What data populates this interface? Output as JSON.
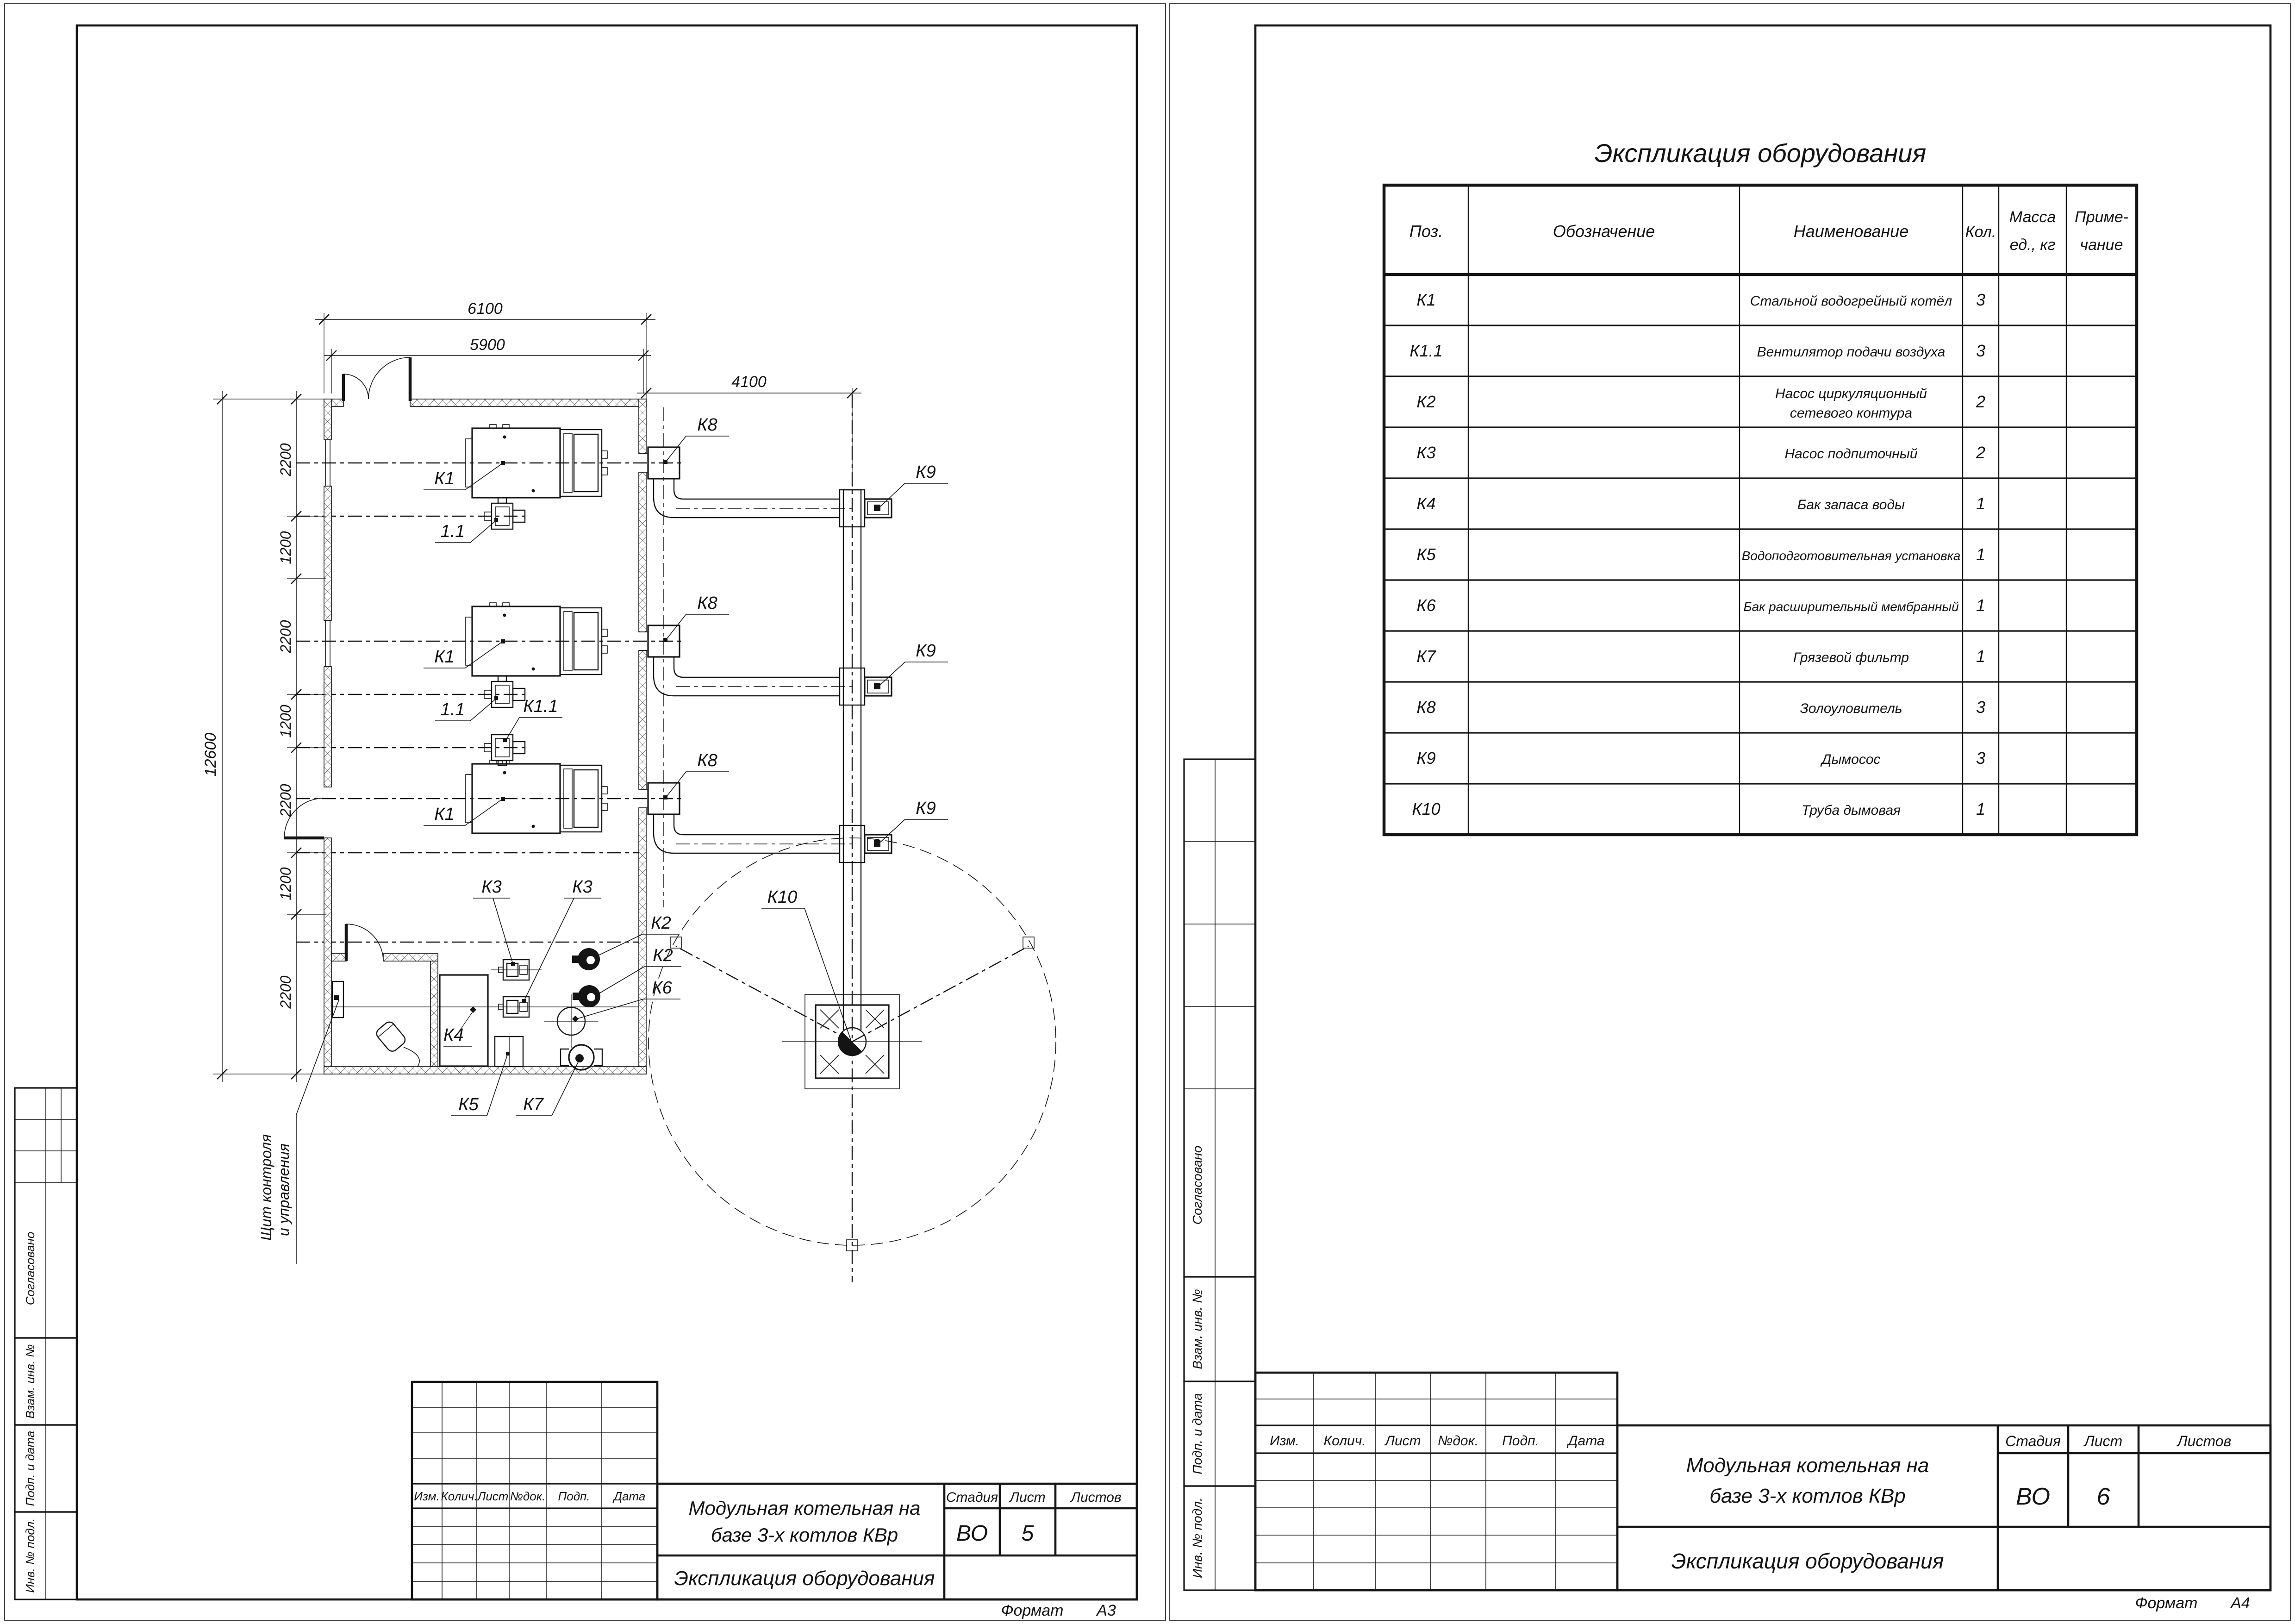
{
  "drawing": {
    "plan_labels": {
      "k1": "К1",
      "fan": "1.1",
      "k1_1": "К1.1",
      "k2": "К2",
      "k3": "К3",
      "k4": "К4",
      "k5": "К5",
      "k6": "К6",
      "k7": "К7",
      "k8": "К8",
      "k9": "К9",
      "k10": "К10"
    },
    "dims": {
      "top_outer": "6100",
      "top_inner": "5900",
      "flue_offset": "4100",
      "left_total": "12600",
      "left_segments": [
        "2200",
        "1200",
        "2200",
        "1200",
        "2200",
        "1200",
        "2200"
      ]
    },
    "control_panel_note_lines": [
      "Щит контроля",
      "и управления"
    ]
  },
  "equipment_table": {
    "title": "Экспликация оборудования",
    "headers": {
      "pos": "Поз.",
      "designation": "Обозначение",
      "name": "Наименование",
      "qty": "Кол.",
      "mass_lines": [
        "Масса",
        "ед., кг"
      ],
      "note_lines": [
        "Приме-",
        "чание"
      ]
    },
    "rows": [
      {
        "pos": "К1",
        "name_lines": [
          "Стальной водогрейный котёл"
        ],
        "qty": "3"
      },
      {
        "pos": "К1.1",
        "name_lines": [
          "Вентилятор подачи воздуха"
        ],
        "qty": "3"
      },
      {
        "pos": "К2",
        "name_lines": [
          "Насос циркуляционный",
          "сетевого контура"
        ],
        "qty": "2"
      },
      {
        "pos": "К3",
        "name_lines": [
          "Насос подпиточный"
        ],
        "qty": "2"
      },
      {
        "pos": "К4",
        "name_lines": [
          "Бак запаса воды"
        ],
        "qty": "1"
      },
      {
        "pos": "К5",
        "name_lines": [
          "Водоподготовительная установка"
        ],
        "qty": "1"
      },
      {
        "pos": "К6",
        "name_lines": [
          "Бак расширительный мембранный"
        ],
        "qty": "1"
      },
      {
        "pos": "К7",
        "name_lines": [
          "Грязевой фильтр"
        ],
        "qty": "1"
      },
      {
        "pos": "К8",
        "name_lines": [
          "Золоуловитель"
        ],
        "qty": "3"
      },
      {
        "pos": "К9",
        "name_lines": [
          "Дымосос"
        ],
        "qty": "3"
      },
      {
        "pos": "К10",
        "name_lines": [
          "Труба дымовая"
        ],
        "qty": "1"
      }
    ]
  },
  "title_block_a3": {
    "revision_headers": [
      "Изм.",
      "Колич.",
      "Лист",
      "№док.",
      "Подп.",
      "Дата"
    ],
    "project_title_lines": [
      "Модульная котельная на",
      "базе 3-х котлов КВр"
    ],
    "stage_label": "Стадия",
    "sheet_label": "Лист",
    "sheets_label": "Листов",
    "stage": "ВО",
    "sheet_no": "5",
    "doc_title": "Экспликация оборудования",
    "format_label": "Формат",
    "format_value": "А3"
  },
  "title_block_a4": {
    "revision_headers": [
      "Изм.",
      "Колич.",
      "Лист",
      "№док.",
      "Подп.",
      "Дата"
    ],
    "project_title_lines": [
      "Модульная котельная на",
      "базе 3-х котлов КВр"
    ],
    "stage_label": "Стадия",
    "sheet_label": "Лист",
    "sheets_label": "Листов",
    "stage": "ВО",
    "sheet_no": "6",
    "doc_title": "Экспликация оборудования",
    "format_label": "Формат",
    "format_value": "А4"
  },
  "side_stamp": {
    "approved": "Согласовано",
    "replace_inv": "Взам. инв. №",
    "sign_date": "Подп. и дата",
    "inv_no": "Инв. № подл."
  }
}
